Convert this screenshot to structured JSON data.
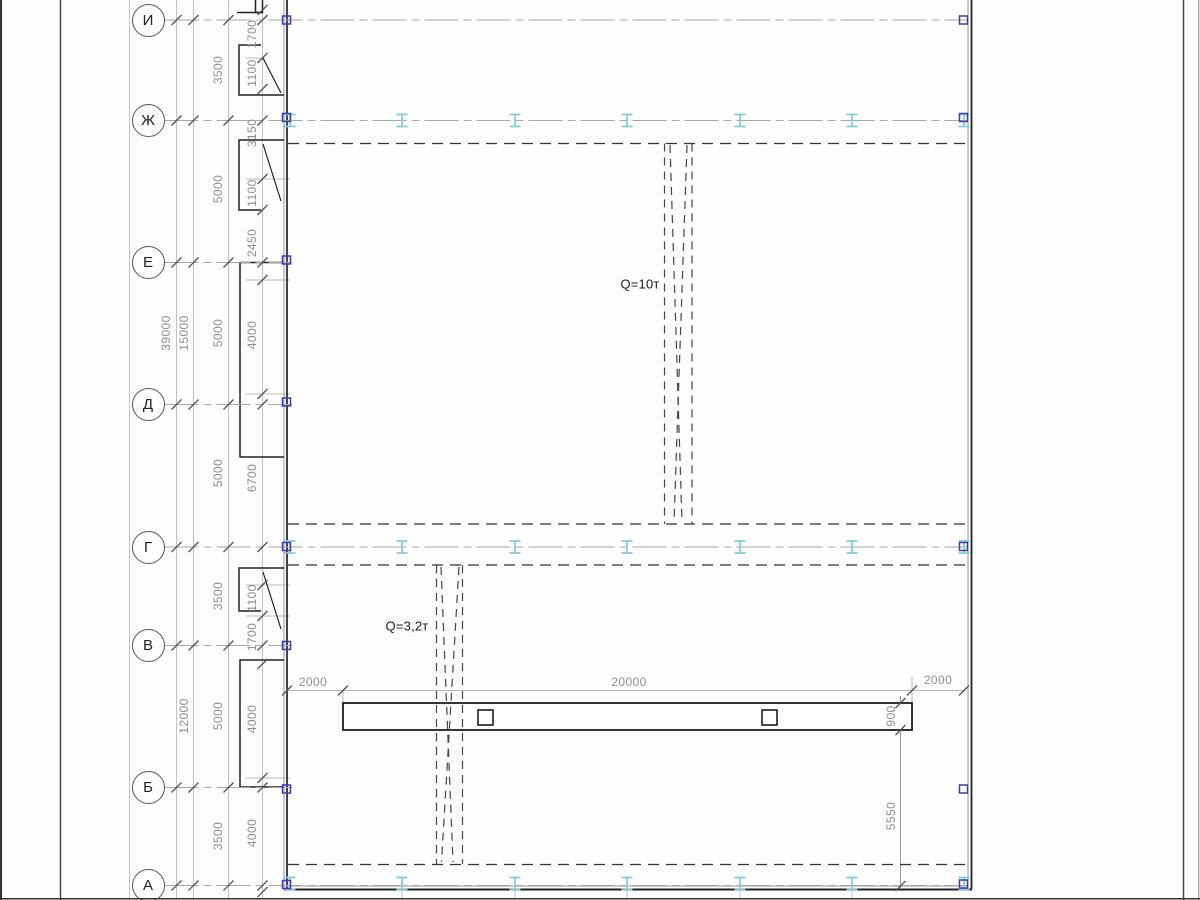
{
  "drawing": {
    "kind": "structural-plan-fragment",
    "crane_labels": [
      "Q=10т",
      "Q=3,2т"
    ]
  },
  "axes": {
    "circle_x": 131.5,
    "items": [
      {
        "label": "И",
        "y": 20,
        "end": 968
      },
      {
        "label": "Ж",
        "y": 120.5,
        "end": 968
      },
      {
        "label": "Е",
        "y": 262.5,
        "end": 292
      },
      {
        "label": "Д",
        "y": 404.5,
        "end": 292
      },
      {
        "label": "Г",
        "y": 547,
        "end": 968
      },
      {
        "label": "В",
        "y": 645.5,
        "end": 292
      },
      {
        "label": "Б",
        "y": 787.5,
        "end": 292
      },
      {
        "label": "А",
        "y": 885.5,
        "end": 968
      }
    ]
  },
  "dims": {
    "tick_xs": [
      176.5,
      193.5,
      228.5,
      262.5
    ],
    "chain_ticks_y": [
      10,
      58,
      89,
      179,
      210,
      280,
      394,
      585,
      616,
      664,
      778,
      892
    ],
    "bottom_ticks_x": [
      287,
      343,
      912,
      964
    ],
    "right_ticks_y": [
      703,
      730,
      886
    ]
  },
  "labels": [
    {
      "t": "39000",
      "x": 166,
      "y": 333,
      "r": 1
    },
    {
      "t": "15000",
      "x": 184,
      "y": 333,
      "r": 1
    },
    {
      "t": "12000",
      "x": 184,
      "y": 716,
      "r": 1
    },
    {
      "t": "3500",
      "x": 218,
      "y": 70,
      "r": 1
    },
    {
      "t": "5000",
      "x": 218,
      "y": 189,
      "r": 1
    },
    {
      "t": "5000",
      "x": 218,
      "y": 333,
      "r": 1
    },
    {
      "t": "5000",
      "x": 218,
      "y": 473,
      "r": 1
    },
    {
      "t": "3500",
      "x": 218,
      "y": 596,
      "r": 1
    },
    {
      "t": "5000",
      "x": 218,
      "y": 716,
      "r": 1
    },
    {
      "t": "3500",
      "x": 218,
      "y": 836,
      "r": 1
    },
    {
      "t": "1700",
      "x": 252,
      "y": 34,
      "r": 1
    },
    {
      "t": "1100",
      "x": 252,
      "y": 73,
      "r": 1
    },
    {
      "t": "3150",
      "x": 252,
      "y": 133,
      "r": 1
    },
    {
      "t": "1100",
      "x": 252,
      "y": 193,
      "r": 1
    },
    {
      "t": "2450",
      "x": 252,
      "y": 243,
      "r": 1
    },
    {
      "t": "4000",
      "x": 252,
      "y": 335,
      "r": 1
    },
    {
      "t": "6700",
      "x": 252,
      "y": 478,
      "r": 1
    },
    {
      "t": "1100",
      "x": 252,
      "y": 598,
      "r": 1
    },
    {
      "t": "1700",
      "x": 252,
      "y": 637,
      "r": 1
    },
    {
      "t": "4000",
      "x": 252,
      "y": 719,
      "r": 1
    },
    {
      "t": "4000",
      "x": 252,
      "y": 833,
      "r": 1
    },
    {
      "t": "900",
      "x": 891,
      "y": 716,
      "r": 1
    },
    {
      "t": "5550",
      "x": 891,
      "y": 816,
      "r": 1
    },
    {
      "t": "2000",
      "x": 313,
      "y": 682,
      "r": 0
    },
    {
      "t": "20000",
      "x": 629,
      "y": 682,
      "r": 0
    },
    {
      "t": "2000",
      "x": 938,
      "y": 680,
      "r": 0
    },
    {
      "t": "Q=10т",
      "x": 640,
      "y": 284,
      "r": 0,
      "c": 1
    },
    {
      "t": "Q=3,2т",
      "x": 407,
      "y": 626,
      "r": 0,
      "c": 1
    }
  ],
  "symbols": {
    "beam_rows": [
      120.5,
      547,
      883.5
    ],
    "beam_cols": [
      290,
      402,
      515,
      627,
      740,
      852,
      964
    ],
    "markers_left_y": [
      20,
      117.5,
      260,
      402,
      546.5,
      645.5,
      789,
      884.5
    ],
    "markers_right_y": [
      20,
      117.5,
      546.5,
      789,
      884
    ]
  },
  "colors": {
    "beam": "#7fcdd9",
    "marker": "#3d3dae",
    "dim_text": "#8f8f8f",
    "wall_line": "#222222",
    "dim_line": "#b5b5b5",
    "axis_line": "#a8a8a8"
  }
}
